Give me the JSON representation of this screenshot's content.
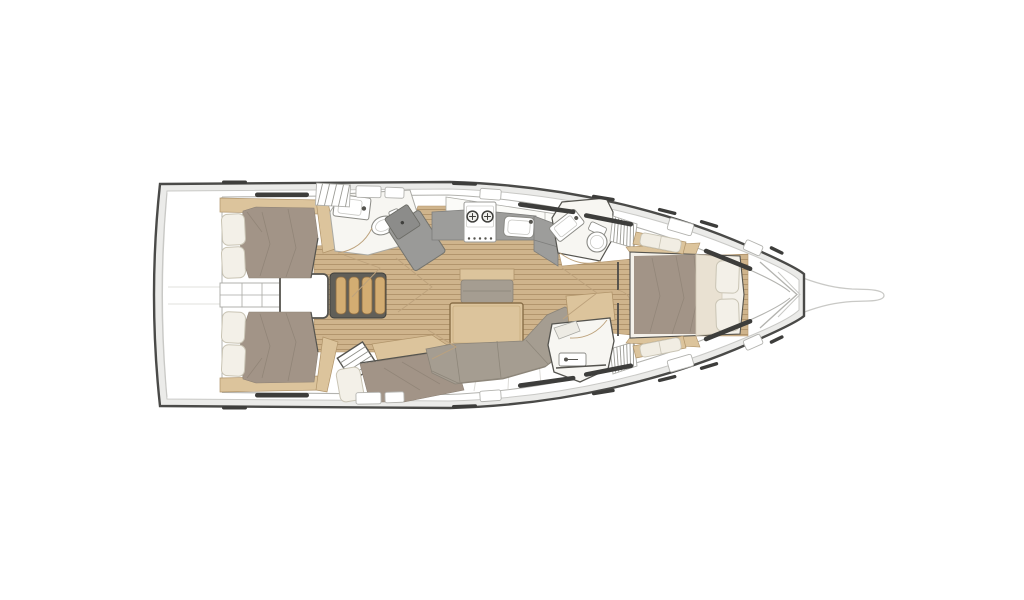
{
  "diagram": {
    "type": "yacht-interior-floor-plan",
    "orientation": {
      "bow": "right",
      "stern": "left",
      "view": "top-down"
    },
    "parts": [
      "hull",
      "bowsprit",
      "transom-swim-platform",
      "aft-cabin-starboard",
      "aft-cabin-port",
      "engine-compartment",
      "companionway-stairs",
      "aft-head",
      "toilet",
      "washbasin",
      "nav-station",
      "galley",
      "stove-two-burner",
      "galley-sink",
      "fridge-counter",
      "salon-table",
      "salon-bench",
      "salon-sofa",
      "mid-cabin-berth",
      "mid-cabin-steps",
      "forward-head",
      "shower-room",
      "hanging-locker-starboard",
      "hanging-locker-port",
      "forward-cabin",
      "v-berth",
      "berth-pillows",
      "side-benches",
      "hull-windows",
      "deck-hatches",
      "door-swing-marks",
      "teak-floor",
      "anchor-locker-bulkhead"
    ],
    "counts": {
      "cabins": 4,
      "heads": 3,
      "berth-pillow-pairs": 4,
      "stove-burners": 2
    }
  },
  "palette": {
    "white": "#ffffff",
    "hullStroke": "#4a4a48",
    "hullSide": "#ebebe9",
    "deckLine": "#c9c9c6",
    "boundary": "#b3b3af",
    "roomFill": "#f7f6f2",
    "roomStroke": "#a9a9a4",
    "boldStroke": "#55544f",
    "teakBase": "#cfb48c",
    "teakLine": "#b2956d",
    "wood": "#dcc49c",
    "woodStroke": "#b0946a",
    "stepWood": "#d3ad72",
    "stairsBg": "#615f58",
    "duvet": "#a29487",
    "duvetFold": "#8b7f72",
    "sofa": "#a59d91",
    "pillow": "#f3f0e8",
    "pillowStroke": "#c9c4b4",
    "cream": "#e9e1d2",
    "counter": "#9d9d9b",
    "counterDark": "#7e7e7c",
    "navDesk": "#9a9a98",
    "navSeat": "#8c8c8a",
    "windowDark": "#3d3d3b",
    "fixture": "#8b8b86",
    "arcLine": "#bda27c"
  }
}
